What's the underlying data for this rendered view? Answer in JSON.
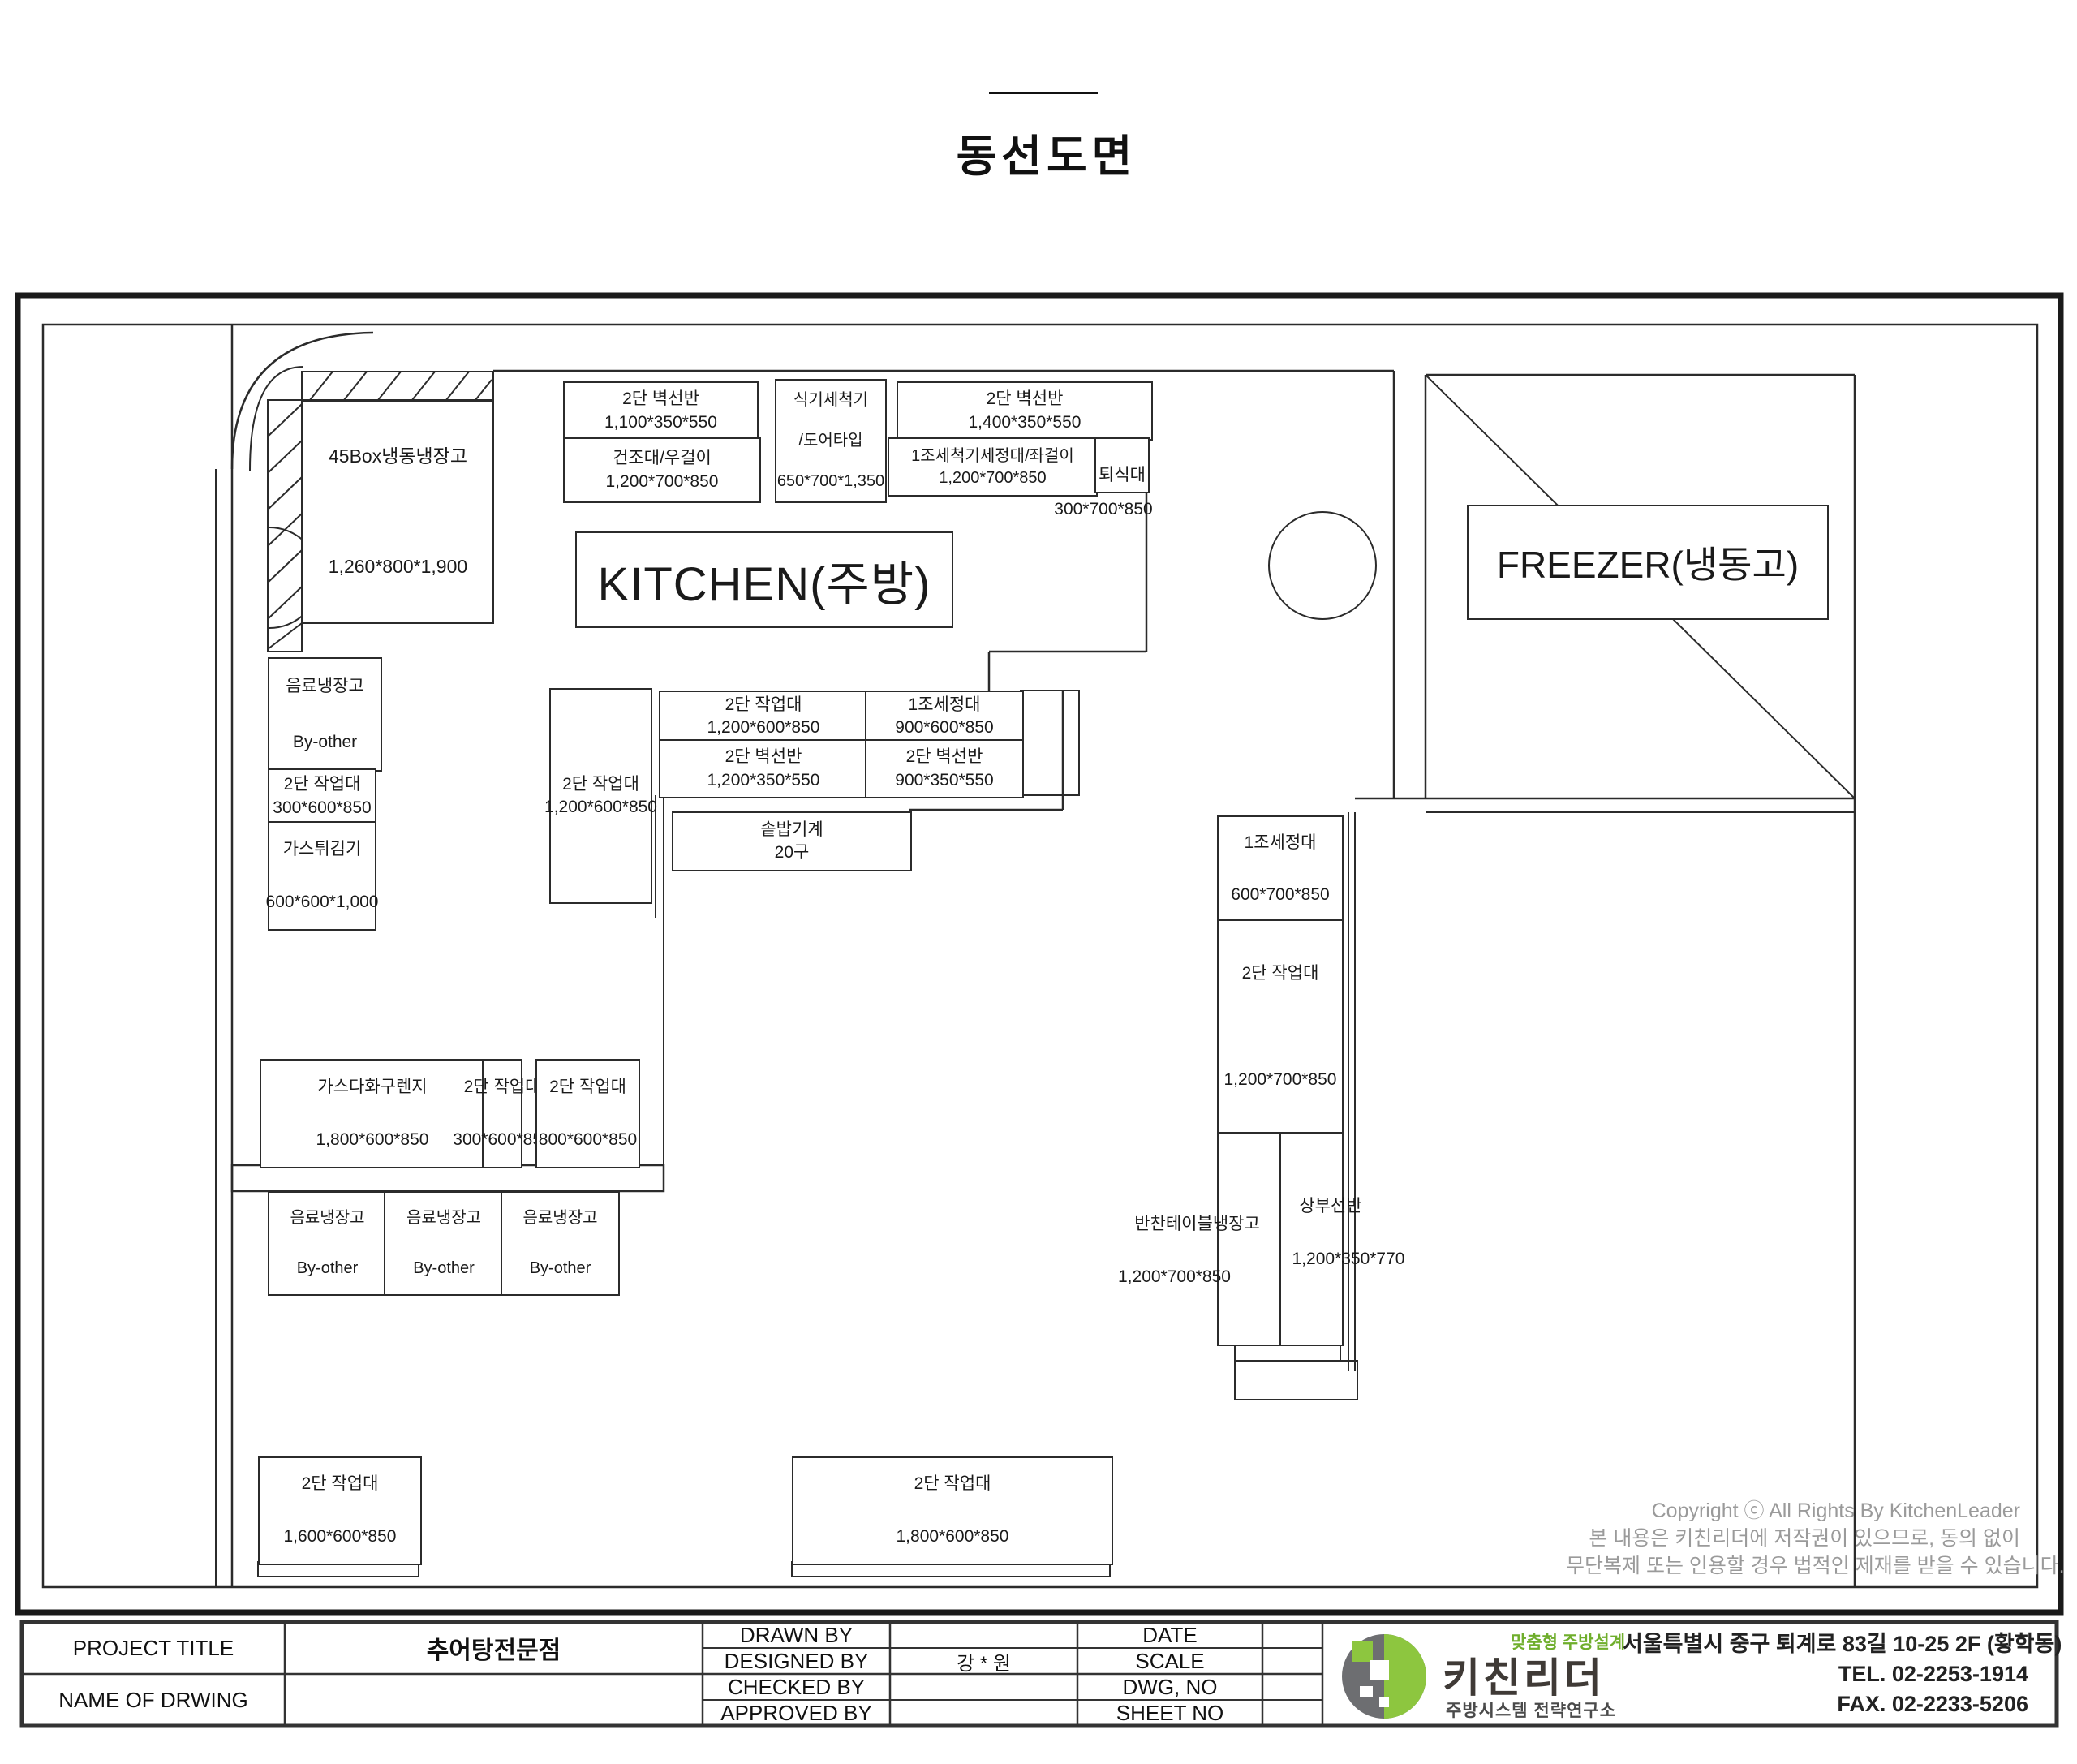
{
  "page": {
    "title": "동선도면"
  },
  "plan": {
    "kitchen_label": "KITCHEN(주방)",
    "freezer_label": "FREEZER(냉동고)",
    "boxes": [
      {
        "name": "fridge-45box",
        "lines": [
          "45Box냉동냉장고",
          "1,260*800*1,900"
        ]
      },
      {
        "name": "wall-shelf-1100",
        "lines": [
          "2단 벽선반",
          "1,100*350*550"
        ]
      },
      {
        "name": "dry-rack",
        "lines": [
          "건조대/우걸이",
          "1,200*700*850"
        ]
      },
      {
        "name": "dishwasher",
        "lines": [
          "식기세척기",
          "/도어타입",
          "650*700*1,350"
        ]
      },
      {
        "name": "wall-shelf-1400",
        "lines": [
          "2단 벽선반",
          "1,400*350*550"
        ]
      },
      {
        "name": "sink-washer-table",
        "lines": [
          "1조세척기세정대/좌걸이",
          "1,200*700*850"
        ]
      },
      {
        "name": "return-table",
        "lines": [
          "퇴식대"
        ]
      },
      {
        "name": "worktable-mid-1200",
        "lines": [
          "2단 작업대",
          "1,200*600*850"
        ]
      },
      {
        "name": "sink-mid-900",
        "lines": [
          "1조세정대",
          "900*600*850"
        ]
      },
      {
        "name": "wall-shelf-mid-1200",
        "lines": [
          "2단 벽선반",
          "1,200*350*550"
        ]
      },
      {
        "name": "wall-shelf-mid-900",
        "lines": [
          "2단 벽선반",
          "900*350*550"
        ]
      },
      {
        "name": "rice-cooker",
        "lines": [
          "솥밥기계",
          "20구"
        ]
      },
      {
        "name": "drink-fridge-top",
        "lines": [
          "음료냉장고",
          "By-other"
        ]
      },
      {
        "name": "worktable-left-300",
        "lines": [
          "2단 작업대",
          "300*600*850"
        ]
      },
      {
        "name": "gas-fryer",
        "lines": [
          "가스튀김기",
          "600*600*1,000"
        ]
      },
      {
        "name": "worktable-vert-1200",
        "lines": [
          "2단 작업대",
          "1,200*600*850"
        ]
      },
      {
        "name": "gas-range",
        "lines": [
          "가스다화구렌지",
          "1,800*600*850"
        ]
      },
      {
        "name": "worktable-gas-300",
        "lines": [
          "2단 작업대",
          "300*600*850"
        ]
      },
      {
        "name": "worktable-gas-800",
        "lines": [
          "2단 작업대",
          "800*600*850"
        ]
      },
      {
        "name": "drink-fridge-1",
        "lines": [
          "음료냉장고",
          "By-other"
        ]
      },
      {
        "name": "drink-fridge-2",
        "lines": [
          "음료냉장고",
          "By-other"
        ]
      },
      {
        "name": "drink-fridge-3",
        "lines": [
          "음료냉장고",
          "By-other"
        ]
      },
      {
        "name": "sink-right-600",
        "lines": [
          "1조세정대",
          "600*700*850"
        ]
      },
      {
        "name": "worktable-right-1200",
        "lines": [
          "2단 작업대",
          "1,200*700*850"
        ]
      },
      {
        "name": "worktable-bottom-1600",
        "lines": [
          "2단 작업대",
          "1,600*600*850"
        ]
      },
      {
        "name": "worktable-bottom-1800",
        "lines": [
          "2단 작업대",
          "1,800*600*850"
        ]
      }
    ],
    "free_labels": [
      {
        "name": "return-table-dims",
        "text": "300*700*850"
      },
      {
        "name": "side-table-fridge",
        "text": "반찬테이블냉장고"
      },
      {
        "name": "side-table-fridge-dims",
        "text": "1,200*700*850"
      },
      {
        "name": "upper-shelf",
        "text": "상부선반"
      },
      {
        "name": "upper-shelf-dims",
        "text": "1,200*350*770"
      }
    ]
  },
  "copyright": {
    "line1": "Copyright ⓒ All Rights By KitchenLeader",
    "line2": "본 내용은 키친리더에 저작권이 있으므로, 동의 없이",
    "line3": "무단복제 또는 인용할 경우 법적인 제재를 받을 수 있습니다."
  },
  "title_block": {
    "project_title_label": "PROJECT TITLE",
    "name_of_drawing_label": "NAME OF DRWING",
    "project_title_value": "추어탕전문점",
    "drawn_by": "DRAWN BY",
    "designed_by": "DESIGNED BY",
    "checked_by": "CHECKED BY",
    "approved_by": "APPROVED BY",
    "designed_by_value": "강 * 원",
    "date": "DATE",
    "scale": "SCALE",
    "dwg_no": "DWG, NO",
    "sheet_no": "SHEET NO"
  },
  "logo": {
    "tagline": "맞춤형 주방설계",
    "brand": "키친리더",
    "subtitle": "주방시스템 전략연구소",
    "address": "서울특별시 중구 퇴계로 83길 10-25 2F (황학동)",
    "tel": "TEL. 02-2253-1914",
    "fax": "FAX. 02-2233-5206"
  },
  "colors": {
    "brand_green": "#8dc63f",
    "brand_gray": "#6d6e71",
    "line": "#2b2b2b"
  }
}
